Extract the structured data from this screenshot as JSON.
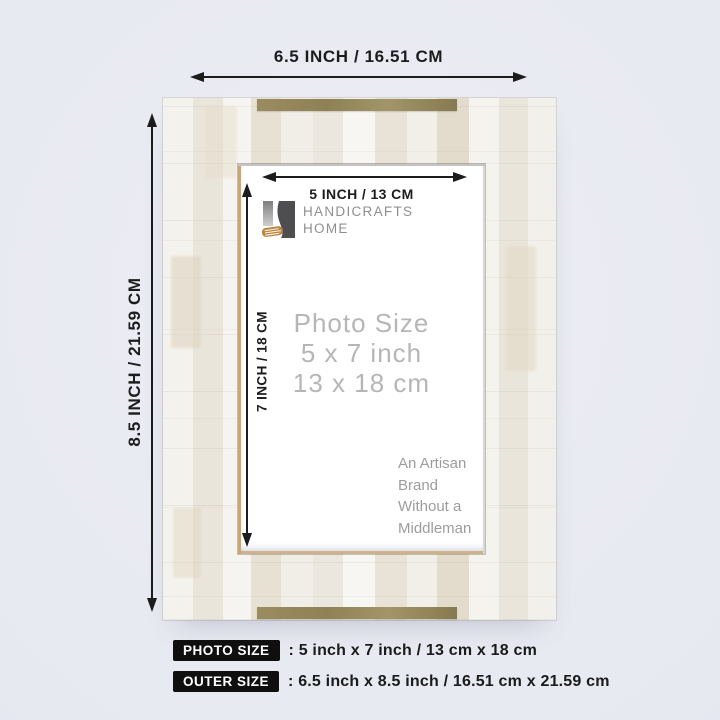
{
  "dimensions": {
    "outer_width_label": "6.5 INCH / 16.51 CM",
    "outer_height_label": "8.5 INCH / 21.59 CM",
    "photo_width_label": "5 INCH / 13 CM",
    "photo_height_label": "7 INCH / 18 CM"
  },
  "brand": {
    "name_line1": "HANDICRAFTS",
    "name_line2": "HOME",
    "tagline_line1": "An Artisan",
    "tagline_line2": "Brand",
    "tagline_line3": "Without a",
    "tagline_line4": "Middleman"
  },
  "photo_size_text": {
    "line1": "Photo Size",
    "line2": "5 x 7 inch",
    "line3": "13 x 18 cm"
  },
  "summary": {
    "rows": [
      {
        "badge": "PHOTO SIZE",
        "value": ": 5 inch x 7 inch / 13 cm x 18 cm"
      },
      {
        "badge": "OUTER SIZE",
        "value": ": 6.5 inch x 8.5 inch / 16.51 cm x 21.59 cm"
      }
    ]
  },
  "colors": {
    "background": "#e7e9f1",
    "arrow": "#1c1c1c",
    "brass_strip": "#95875c",
    "badge_background": "#0f0f0f",
    "badge_text": "#ffffff",
    "logo_orange": "#c08440",
    "logo_dark_grey": "#4e4e50",
    "photo_size_text": "#b6b6b6"
  }
}
